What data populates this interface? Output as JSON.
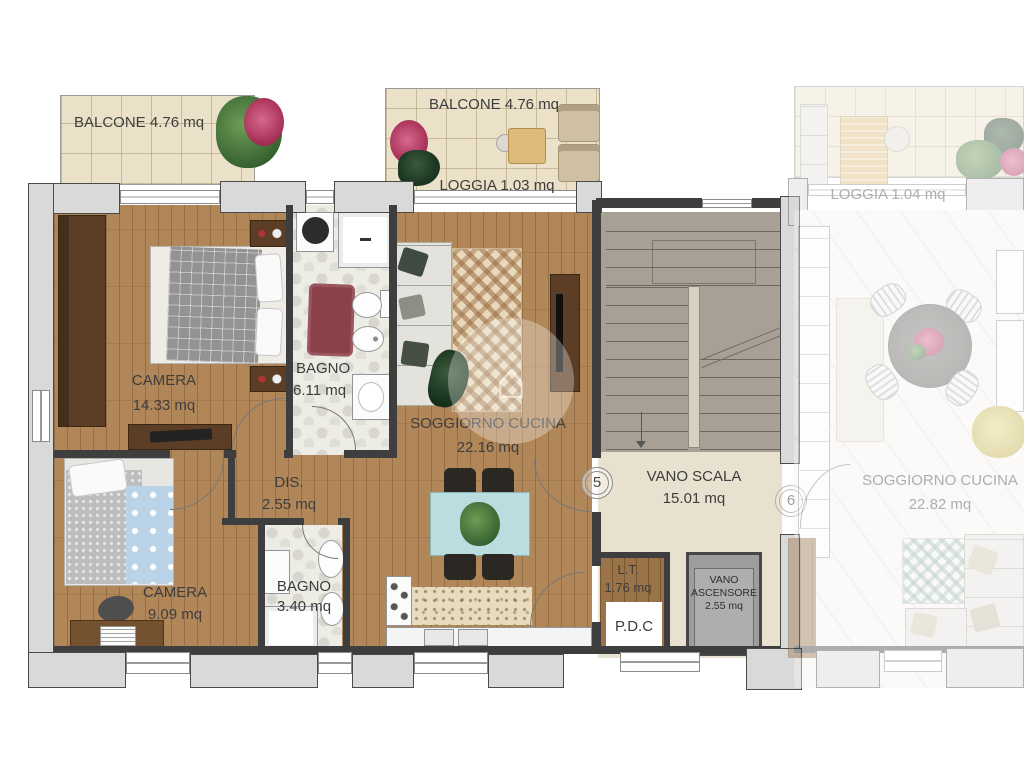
{
  "labels": {
    "balcone_tl": "BALCONE 4.76 mq",
    "balcone_tc": "BALCONE 4.76 mq",
    "loggia_tc": "LOGGIA 1.03 mq",
    "camera1_name": "CAMERA",
    "camera1_area": "14.33 mq",
    "bagno1_name": "BAGNO",
    "bagno1_area": "6.11 mq",
    "soggiorno5_name": "SOGGIORNO CUCINA",
    "soggiorno5_area": "22.16 mq",
    "dis_name": "DIS.",
    "dis_area": "2.55 mq",
    "camera2_name": "CAMERA",
    "camera2_area": "9.09 mq",
    "bagno2_name": "BAGNO",
    "bagno2_area": "3.40 mq",
    "scala_name": "VANO SCALA",
    "scala_area": "15.01 mq",
    "lt_name": "L.T.",
    "lt_area": "1.76 mq",
    "pdc": "P.D.C",
    "asc_line1": "VANO",
    "asc_line2": "ASCENSORE",
    "asc_area": "2.55 mq",
    "unit5": "5",
    "unit6": "6",
    "loggia_u6": "LOGGIA 1.04 mq",
    "soggiorno6_name": "SOGGIORNO CUCINA",
    "soggiorno6_area": "22.82 mq"
  },
  "colors": {
    "wood_floor": "#b1875a",
    "balcony_tile": "#ebe1c9",
    "bath_tile": "#edece5",
    "marble_floor": "#f6f4f0",
    "wall_dark": "#3e3e3e",
    "wall_gray": "#d9d9d9",
    "stair": "#a8a094",
    "landing": "#e9e1cf",
    "elevator": "#9d9d9d",
    "rug_red": "#8c4049",
    "dining_table_blue": "#badde0",
    "blanket_blue": "#bad3e6"
  }
}
